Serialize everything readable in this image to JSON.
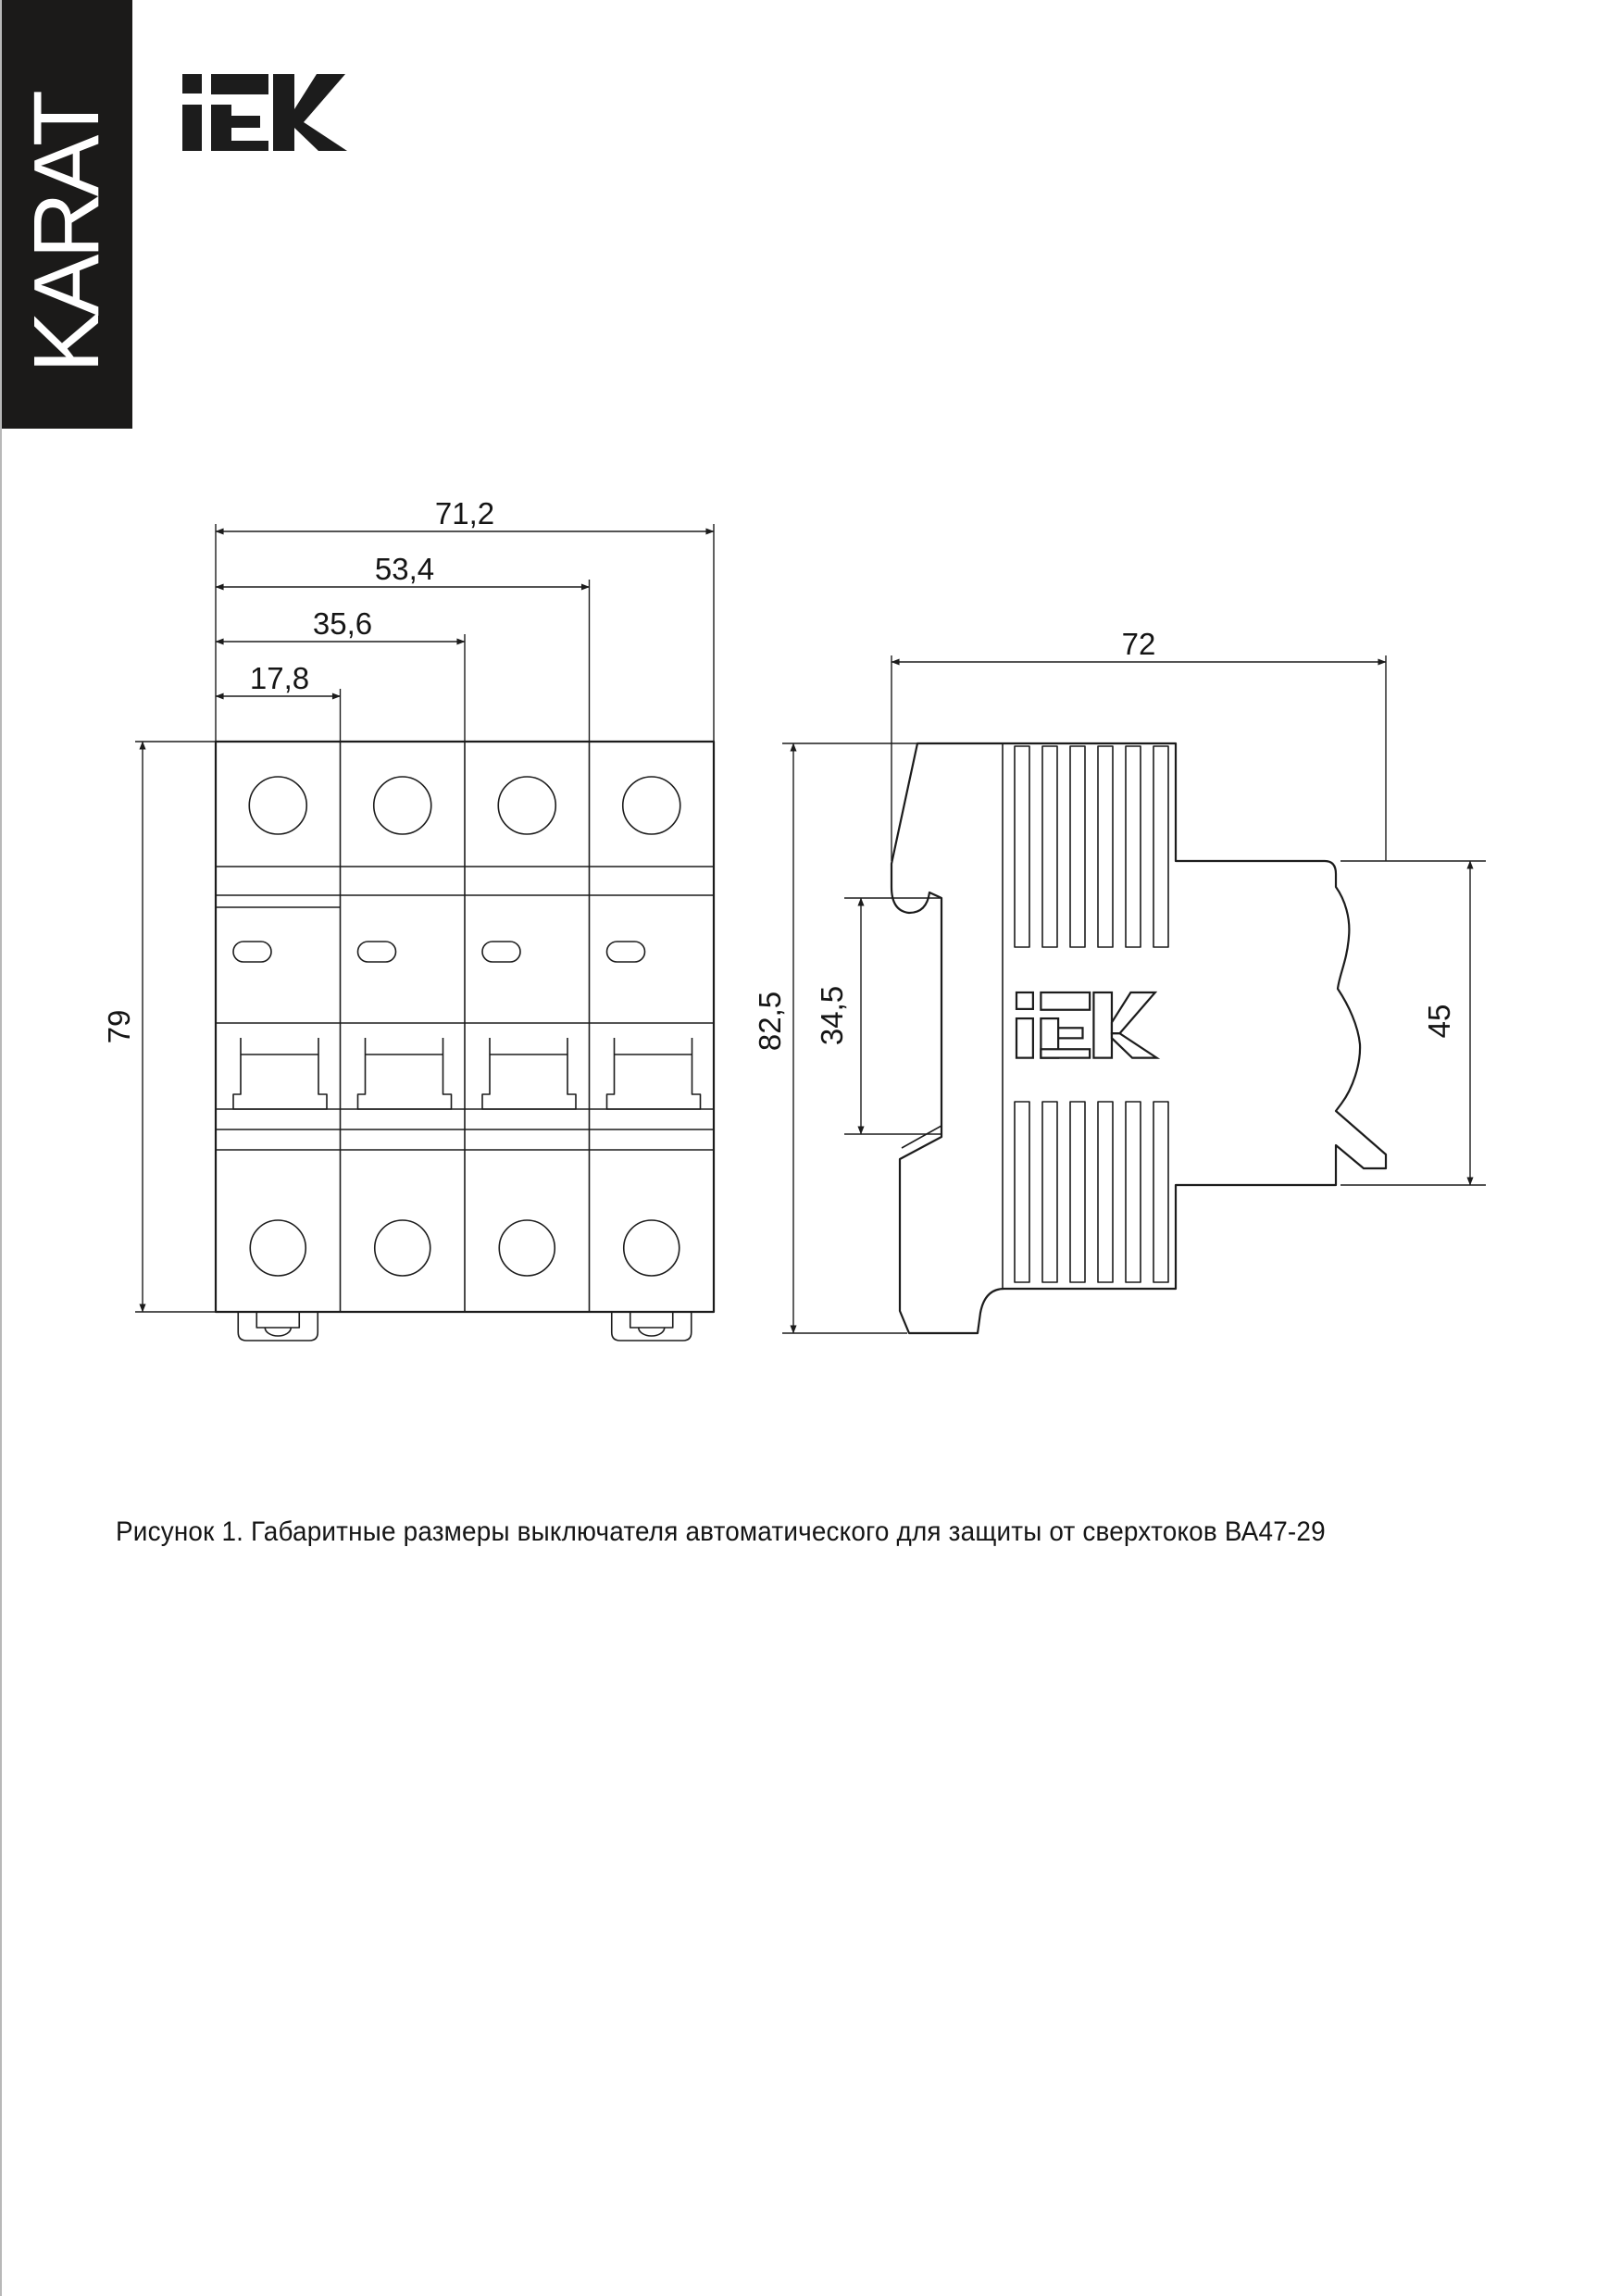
{
  "page": {
    "background": "#ffffff",
    "line_color": "#1c1c1c"
  },
  "brand_bar": {
    "label": "KARAT",
    "bg": "#1b1a19",
    "fg": "#ffffff"
  },
  "logo": {
    "alt": "IEK"
  },
  "figure": {
    "caption": "Рисунок 1. Габаритные размеры выключателя автоматического для защиты от сверхтоков ВА47-29",
    "front_view": {
      "dim_width_total": "71,2",
      "dim_width_3": "53,4",
      "dim_width_2": "35,6",
      "dim_width_1": "17,8",
      "dim_height": "79"
    },
    "side_view": {
      "dim_depth": "72",
      "dim_height_total": "82,5",
      "dim_rail_recess": "34,5",
      "dim_front_height": "45"
    }
  }
}
